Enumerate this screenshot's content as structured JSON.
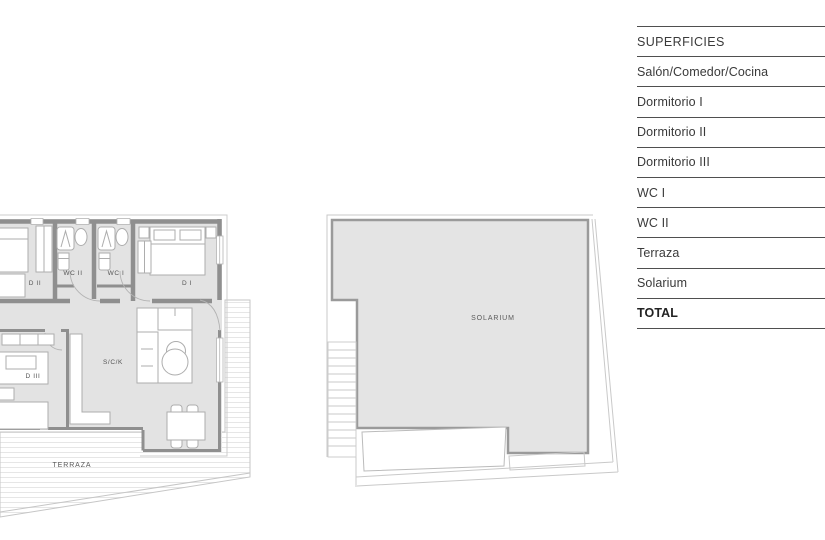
{
  "surfaces_table": {
    "header": "SUPERFICIES",
    "rows": [
      "Salón/Comedor/Cocina",
      "Dormitorio I",
      "Dormitorio II",
      "Dormitorio III",
      "WC I",
      "WC II",
      "Terraza",
      "Solarium"
    ],
    "total": "TOTAL"
  },
  "floor_plan": {
    "rooms": {
      "d1": "D I",
      "d2": "D II",
      "d3": "D III",
      "wc1": "WC I",
      "wc2": "WC II",
      "sck": "S/C/K",
      "terraza": "TERRAZA"
    }
  },
  "solarium_plan": {
    "label": "SOLARIUM"
  },
  "colors": {
    "plan_fill": "#e3e3e3",
    "wall": "#8f8f8f",
    "thin_outline": "#c9c9c9",
    "furniture_stroke": "#adadad",
    "table_line": "#4f4f4f",
    "table_text": "#3a3a3a",
    "label_text": "#555555",
    "background": "#ffffff"
  }
}
